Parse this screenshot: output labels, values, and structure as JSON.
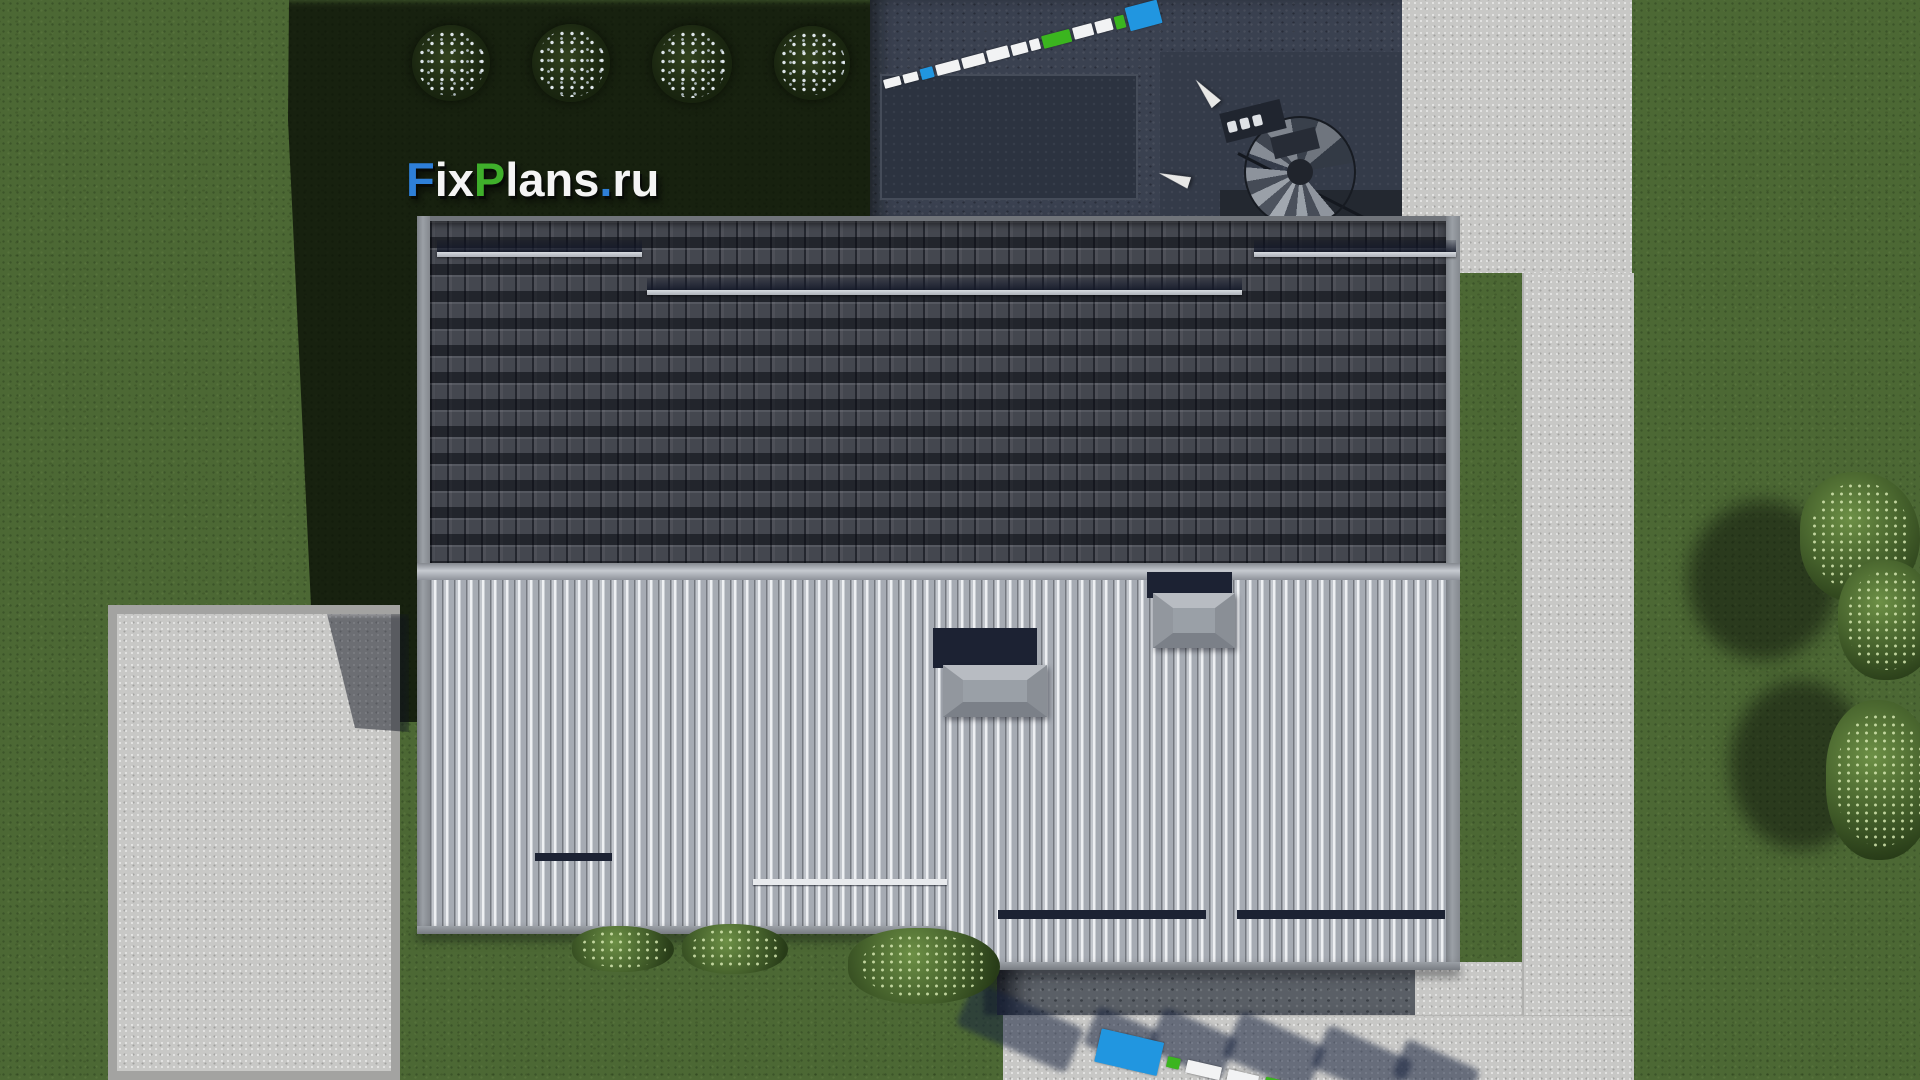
{
  "watermark": {
    "site": "FixPlans.ru",
    "parts": [
      {
        "text": "F",
        "color": "#2e7fd8"
      },
      {
        "text": "ix",
        "color": "#f4f4f4"
      },
      {
        "text": "P",
        "color": "#3faf2b"
      },
      {
        "text": "lans",
        "color": "#f4f4f4"
      },
      {
        "text": ".",
        "color": "#2e7fd8"
      },
      {
        "text": "ru",
        "color": "#f4f4f4"
      }
    ]
  },
  "palette": {
    "grass_lit": "#4c6834",
    "grass_shadow": "#1d2a16",
    "roof_dark_tiles": "#44474f",
    "roof_light_tiles": "#b3b7bd",
    "ridge": "#c6cad0",
    "fascia": "#9ba0a6",
    "concrete": "#c8c8c6",
    "stone_patio": "#3a4150",
    "brand_blue": "#2196e0",
    "brand_green": "#3bb51f",
    "brand_white": "#f2f3f4",
    "snow_rail_navy": "#1c2233"
  },
  "measuring_stick_top": {
    "segments": [
      {
        "c": "#f2f3f4",
        "w": 17,
        "h": 9
      },
      {
        "c": "#f2f3f4",
        "w": 15,
        "h": 9
      },
      {
        "c": "#2196e0",
        "w": 13,
        "h": 11
      },
      {
        "c": "#f2f3f4",
        "w": 24,
        "h": 11
      },
      {
        "c": "#f2f3f4",
        "w": 23,
        "h": 11
      },
      {
        "c": "#f2f3f4",
        "w": 22,
        "h": 12
      },
      {
        "c": "#f2f3f4",
        "w": 16,
        "h": 11
      },
      {
        "c": "#f2f3f4",
        "w": 10,
        "h": 11
      },
      {
        "c": "#3bb51f",
        "w": 29,
        "h": 13
      },
      {
        "c": "#f2f3f4",
        "w": 20,
        "h": 12
      },
      {
        "c": "#f2f3f4",
        "w": 17,
        "h": 12
      },
      {
        "c": "#3bb51f",
        "w": 10,
        "h": 13
      },
      {
        "c": "#2196e0",
        "w": 33,
        "h": 24
      }
    ]
  },
  "measuring_stick_bottom": {
    "segments": [
      {
        "c": "#2196e0",
        "w": 64,
        "h": 34
      },
      {
        "c": "#3bb51f",
        "w": 13,
        "h": 11
      },
      {
        "c": "#f2f3f4",
        "w": 35,
        "h": 13
      },
      {
        "c": "#f2f3f4",
        "w": 31,
        "h": 13
      },
      {
        "c": "#3bb51f",
        "w": 54,
        "h": 15
      },
      {
        "c": "#f2f3f4",
        "w": 26,
        "h": 13
      }
    ]
  }
}
